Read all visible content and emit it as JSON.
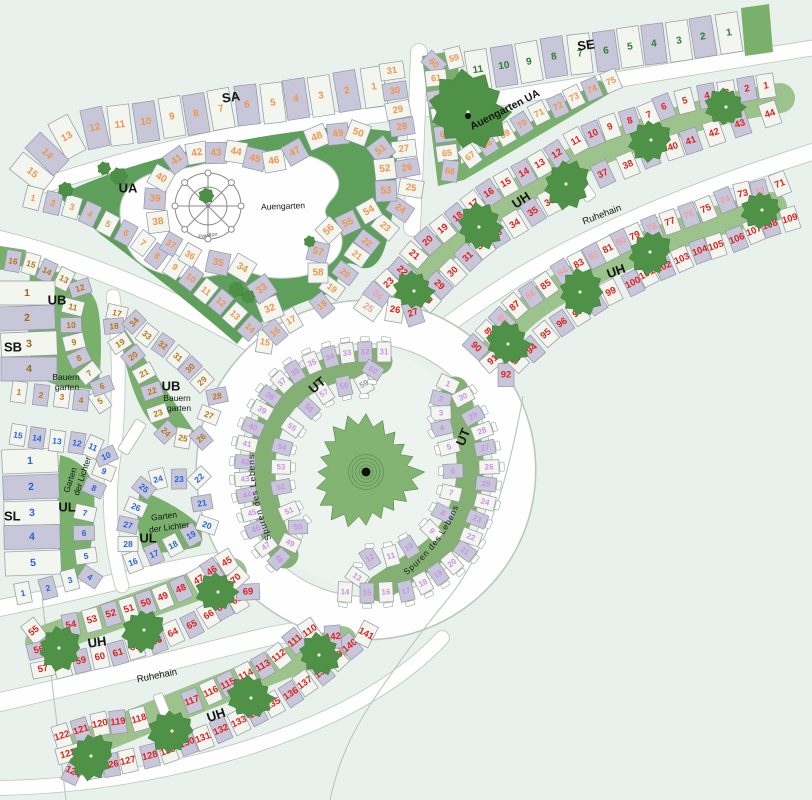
{
  "map": {
    "background": "#e9f1ec",
    "colors": {
      "road": "#fdfefd",
      "road_edge": "#b9c6bb",
      "cell_fill_a": "#c8c7da",
      "cell_fill_b": "#f2f6ee",
      "cell_stroke": "#9595a4",
      "green_area": "#5d9f5b",
      "green_wedge": "#79b06c",
      "green_band": "#9dc38c",
      "green_ut": "#84b173",
      "tree": "#4f9147",
      "center_tree": "#83b471",
      "plaza": "#edf3ee",
      "structure": "#ffffff",
      "label_text": "#141414"
    },
    "number_colors": {
      "SA": "#f0954e",
      "SE": "#2f7d33",
      "UA": "#f0954e",
      "UB": "#b9761c",
      "SB": "#9a6a22",
      "SL": "#2b62d9",
      "UL": "#2b62d9",
      "UT": "#c993e4",
      "UT_grey": "#9aa0a6",
      "UH": "#e02020",
      "UH_pale": "#eda0a6"
    },
    "sections": [
      {
        "code": "SA",
        "plots": "1-15"
      },
      {
        "code": "SE",
        "plots": "1-11"
      },
      {
        "code": "UA",
        "name": "Auengarten",
        "plots": "1-75"
      },
      {
        "code": "UB",
        "name": "Bauerngarten",
        "plots": "1-34"
      },
      {
        "code": "SB",
        "plots": "1-4"
      },
      {
        "code": "SL",
        "plots": "1-5"
      },
      {
        "code": "UL",
        "name": "Garten der Lichter",
        "plots": "1-28"
      },
      {
        "code": "UT",
        "name": "Spuren des Lebens",
        "plots": "1-60"
      },
      {
        "code": "UH",
        "name": "Ruhehain",
        "plots": "1-142"
      }
    ],
    "labels": {
      "sa": "SA",
      "se": "SE",
      "ua": "UA",
      "ub": "UB",
      "sb": "SB",
      "sl": "SL",
      "ul": "UL",
      "ut": "UT",
      "uh": "UH",
      "auengarten": "Auengarten",
      "auengarten_ua": "Auengarten UA",
      "pavillon": "Pavillon",
      "bauern": "Bauern",
      "garten": "garten",
      "garten2": "Garten",
      "der_lichter": "der Lichter",
      "spuren": "Spuren des Lebens",
      "ruhehain": "Ruhehain"
    },
    "strips": [
      {
        "id": "sa",
        "section": "SA",
        "from": 1,
        "to": 15
      },
      {
        "id": "se",
        "section": "SE",
        "from": 1,
        "to": 11
      },
      {
        "id": "ua1",
        "section": "UA",
        "from": 1,
        "to": 22
      },
      {
        "id": "ua2",
        "section": "UA",
        "from": 23,
        "to": 31
      },
      {
        "id": "ua3",
        "section": "UA",
        "from": 32,
        "to": 35
      },
      {
        "id": "ua4",
        "section": "UA",
        "from": 36,
        "to": 37
      },
      {
        "id": "ua5",
        "section": "UA",
        "from": 38,
        "to": 53
      },
      {
        "id": "ua6",
        "section": "UA",
        "from": 54,
        "to": 58
      },
      {
        "id": "ua7",
        "section": "UA",
        "from": 59,
        "to": 75
      },
      {
        "id": "ub1",
        "section": "UB",
        "from": 1,
        "to": 16
      },
      {
        "id": "ub2",
        "section": "UB",
        "from": 17,
        "to": 34
      },
      {
        "id": "sb",
        "section": "SB",
        "from": 1,
        "to": 4
      },
      {
        "id": "sl",
        "section": "SL",
        "from": 1,
        "to": 5
      },
      {
        "id": "ul1",
        "section": "UL",
        "from": 1,
        "to": 15
      },
      {
        "id": "ul2",
        "section": "UL",
        "from": 16,
        "to": 28
      },
      {
        "id": "utr_in",
        "section": "UT",
        "from": 1,
        "to": 13
      },
      {
        "id": "utr_out",
        "section": "UT",
        "from": 14,
        "to": 30
      },
      {
        "id": "utl_out",
        "section": "UT",
        "from": 31,
        "to": 48
      },
      {
        "id": "utl_in",
        "section": "UT",
        "from": 49,
        "to": 60
      },
      {
        "id": "uha_top",
        "section": "UH",
        "from": 1,
        "to": 25
      },
      {
        "id": "uha_bot",
        "section": "UH",
        "from": 26,
        "to": 44
      },
      {
        "id": "uhc_top",
        "section": "UH",
        "from": 45,
        "to": 57
      },
      {
        "id": "uhc_bot",
        "section": "UH",
        "from": 58,
        "to": 70
      },
      {
        "id": "uhb_top",
        "section": "UH",
        "from": 71,
        "to": 90
      },
      {
        "id": "uhb_bot",
        "section": "UH",
        "from": 91,
        "to": 109
      },
      {
        "id": "uhd_top",
        "section": "UH",
        "from": 110,
        "to": 122
      },
      {
        "id": "uhd_bot",
        "section": "UH",
        "from": 123,
        "to": 142
      }
    ],
    "special_numbers": {
      "pale_UH": [
        24,
        25,
        72,
        74,
        76,
        78,
        80,
        82,
        84,
        86,
        88
      ],
      "grey_UT": [
        59
      ]
    }
  }
}
